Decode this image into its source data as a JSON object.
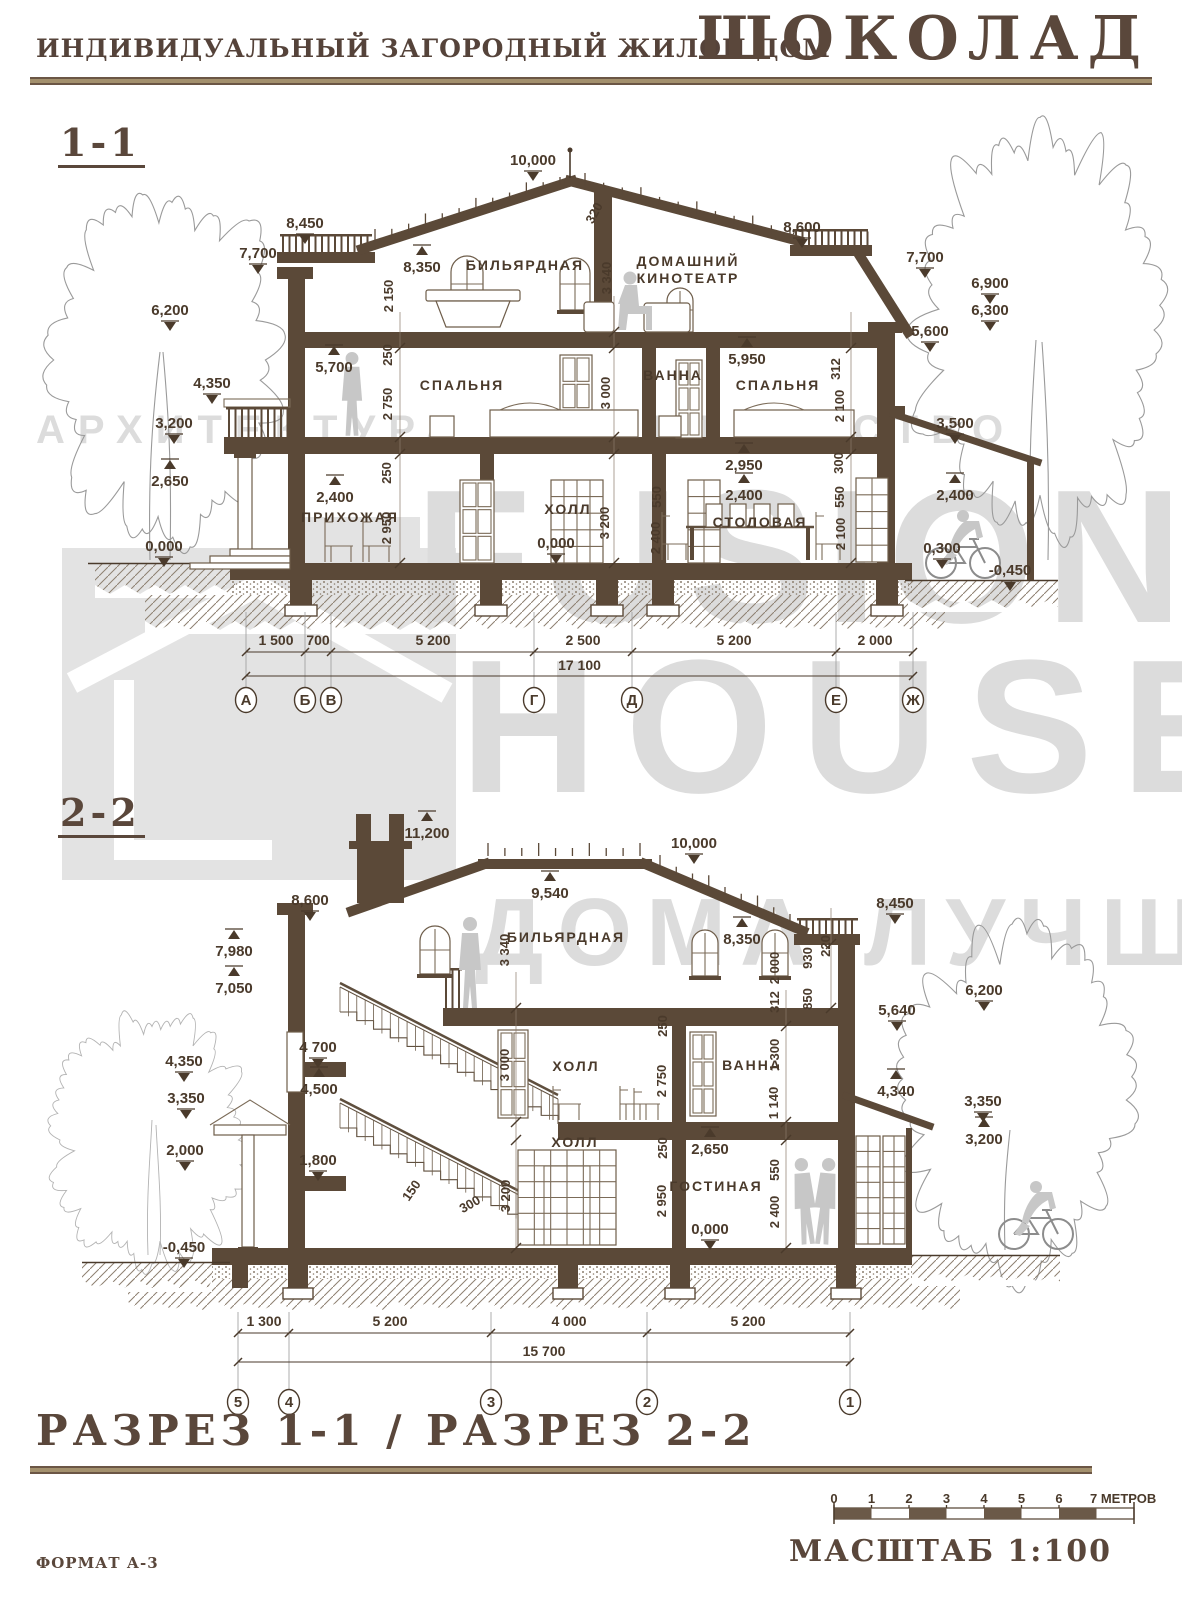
{
  "header": {
    "title": "ИНДИВИДУАЛЬНЫЙ ЗАГОРОДНЫЙ ЖИЛОЙ ДОМ",
    "logo": "ШОКОЛАД"
  },
  "watermark": {
    "tagline": "АРХИТЕКТУРА СТРОИТЕЛЬСТВО",
    "brand1": "FUSION",
    "brand2": "HOUSE",
    "slogan": "ДОМА ЛУЧШЕ!"
  },
  "colors": {
    "ink": "#4a3a2b",
    "wall": "#5b4938",
    "tan": "#a3906d",
    "watermark": "#dcdcdc"
  },
  "section1": {
    "label": "1-1",
    "rooms": [
      {
        "t": "БИЛЬЯРДНАЯ",
        "x": 525,
        "y": 270
      },
      {
        "t": "ДОМАШНИЙ",
        "x": 688,
        "y": 266
      },
      {
        "t": "КИНОТЕАТР",
        "x": 688,
        "y": 283
      },
      {
        "t": "СПАЛЬНЯ",
        "x": 462,
        "y": 390
      },
      {
        "t": "ВАННА",
        "x": 673,
        "y": 380
      },
      {
        "t": "СПАЛЬНЯ",
        "x": 778,
        "y": 390
      },
      {
        "t": "ПРИХОЖАЯ",
        "x": 350,
        "y": 522
      },
      {
        "t": "ХОЛЛ",
        "x": 568,
        "y": 514
      },
      {
        "t": "СТОЛОВАЯ",
        "x": 760,
        "y": 527
      }
    ],
    "marks": [
      {
        "v": "10,000",
        "x": 533,
        "y": 165,
        "d": "d"
      },
      {
        "v": "8,450",
        "x": 305,
        "y": 228,
        "d": "d"
      },
      {
        "v": "7,700",
        "x": 258,
        "y": 258,
        "d": "d"
      },
      {
        "v": "6,200",
        "x": 170,
        "y": 315,
        "d": "d"
      },
      {
        "v": "4,350",
        "x": 212,
        "y": 388,
        "d": "d"
      },
      {
        "v": "3,200",
        "x": 174,
        "y": 428,
        "d": "d"
      },
      {
        "v": "2,650",
        "x": 170,
        "y": 486,
        "d": "u"
      },
      {
        "v": "0,000",
        "x": 164,
        "y": 551,
        "d": "d"
      },
      {
        "v": "5,700",
        "x": 334,
        "y": 372,
        "d": "u"
      },
      {
        "v": "8,350",
        "x": 422,
        "y": 272,
        "d": "u"
      },
      {
        "v": "8,600",
        "x": 802,
        "y": 232,
        "d": "d"
      },
      {
        "v": "7,700",
        "x": 925,
        "y": 262,
        "d": "d"
      },
      {
        "v": "6,900",
        "x": 990,
        "y": 288,
        "d": "d"
      },
      {
        "v": "6,300",
        "x": 990,
        "y": 315,
        "d": "d"
      },
      {
        "v": "5,600",
        "x": 930,
        "y": 336,
        "d": "d"
      },
      {
        "v": "5,950",
        "x": 747,
        "y": 364,
        "d": "u"
      },
      {
        "v": "3,500",
        "x": 955,
        "y": 428,
        "d": "d"
      },
      {
        "v": "2,950",
        "x": 744,
        "y": 470,
        "d": "u"
      },
      {
        "v": "2,400",
        "x": 744,
        "y": 500,
        "d": "u"
      },
      {
        "v": "2,400",
        "x": 335,
        "y": 502,
        "d": "u"
      },
      {
        "v": "2,400",
        "x": 955,
        "y": 500,
        "d": "u"
      },
      {
        "v": "0,000",
        "x": 556,
        "y": 548,
        "d": "d"
      },
      {
        "v": "0,300",
        "x": 942,
        "y": 553,
        "d": "d"
      },
      {
        "v": "-0,450",
        "x": 1010,
        "y": 575,
        "d": "d"
      }
    ],
    "vdims": [
      {
        "v": "320",
        "x": 598,
        "y": 215,
        "r": -62
      },
      {
        "v": "2 150",
        "x": 393,
        "y": 296
      },
      {
        "v": "250",
        "x": 392,
        "y": 355
      },
      {
        "v": "2 750",
        "x": 392,
        "y": 404
      },
      {
        "v": "250",
        "x": 391,
        "y": 473
      },
      {
        "v": "2 950",
        "x": 391,
        "y": 528
      },
      {
        "v": "3 340",
        "x": 611,
        "y": 278
      },
      {
        "v": "3 000",
        "x": 610,
        "y": 393
      },
      {
        "v": "3 200",
        "x": 609,
        "y": 523
      },
      {
        "v": "550",
        "x": 661,
        "y": 497
      },
      {
        "v": "2 400",
        "x": 660,
        "y": 538
      },
      {
        "v": "312",
        "x": 840,
        "y": 369
      },
      {
        "v": "2 100",
        "x": 844,
        "y": 406
      },
      {
        "v": "300",
        "x": 843,
        "y": 463
      },
      {
        "v": "550",
        "x": 844,
        "y": 497
      },
      {
        "v": "2 100",
        "x": 845,
        "y": 534
      }
    ],
    "dims": [
      {
        "v": "1 500",
        "x": 276
      },
      {
        "v": "700",
        "x": 318
      },
      {
        "v": "5 200",
        "x": 433
      },
      {
        "v": "2 500",
        "x": 583
      },
      {
        "v": "5 200",
        "x": 734
      },
      {
        "v": "2 000",
        "x": 875
      }
    ],
    "total": "17 100",
    "axes": [
      {
        "v": "А",
        "x": 246
      },
      {
        "v": "Б",
        "x": 305
      },
      {
        "v": "В",
        "x": 331
      },
      {
        "v": "Г",
        "x": 534
      },
      {
        "v": "Д",
        "x": 632
      },
      {
        "v": "Е",
        "x": 836
      },
      {
        "v": "Ж",
        "x": 913
      }
    ]
  },
  "section2": {
    "label": "2-2",
    "rooms": [
      {
        "t": "БИЛЬЯРДНАЯ",
        "x": 566,
        "y": 942
      },
      {
        "t": "ХОЛЛ",
        "x": 576,
        "y": 1071
      },
      {
        "t": "ВАННА",
        "x": 752,
        "y": 1070
      },
      {
        "t": "ХОЛЛ",
        "x": 575,
        "y": 1147
      },
      {
        "t": "ГОСТИНАЯ",
        "x": 716,
        "y": 1191
      }
    ],
    "marks": [
      {
        "v": "11,200",
        "x": 427,
        "y": 838,
        "d": "u"
      },
      {
        "v": "10,000",
        "x": 694,
        "y": 848,
        "d": "d"
      },
      {
        "v": "9,540",
        "x": 550,
        "y": 898,
        "d": "u"
      },
      {
        "v": "8,600",
        "x": 310,
        "y": 905,
        "d": "d"
      },
      {
        "v": "8,450",
        "x": 895,
        "y": 908,
        "d": "d"
      },
      {
        "v": "8,350",
        "x": 742,
        "y": 944,
        "d": "u"
      },
      {
        "v": "7,980",
        "x": 234,
        "y": 956,
        "d": "u"
      },
      {
        "v": "7,050",
        "x": 234,
        "y": 993,
        "d": "u"
      },
      {
        "v": "6,200",
        "x": 984,
        "y": 995,
        "d": "d"
      },
      {
        "v": "5,640",
        "x": 897,
        "y": 1015,
        "d": "d"
      },
      {
        "v": "4 700",
        "x": 318,
        "y": 1052,
        "d": "d"
      },
      {
        "v": "4,500",
        "x": 319,
        "y": 1094,
        "d": "u"
      },
      {
        "v": "1,800",
        "x": 318,
        "y": 1165,
        "d": "d"
      },
      {
        "v": "4,350",
        "x": 184,
        "y": 1066,
        "d": "d"
      },
      {
        "v": "3,350",
        "x": 186,
        "y": 1103,
        "d": "d"
      },
      {
        "v": "2,000",
        "x": 185,
        "y": 1155,
        "d": "d"
      },
      {
        "v": "-0,450",
        "x": 184,
        "y": 1252,
        "d": "d"
      },
      {
        "v": "4,340",
        "x": 896,
        "y": 1096,
        "d": "u"
      },
      {
        "v": "3,350",
        "x": 983,
        "y": 1106,
        "d": "d"
      },
      {
        "v": "3,200",
        "x": 984,
        "y": 1144,
        "d": "u"
      },
      {
        "v": "2,650",
        "x": 710,
        "y": 1154,
        "d": "u"
      },
      {
        "v": "0,000",
        "x": 710,
        "y": 1234,
        "d": "d"
      }
    ],
    "vdims": [
      {
        "v": "3 340",
        "x": 509,
        "y": 950
      },
      {
        "v": "2 000",
        "x": 779,
        "y": 968
      },
      {
        "v": "930",
        "x": 812,
        "y": 958
      },
      {
        "v": "220",
        "x": 830,
        "y": 946
      },
      {
        "v": "850",
        "x": 812,
        "y": 999
      },
      {
        "v": "312",
        "x": 779,
        "y": 1002
      },
      {
        "v": "3 000",
        "x": 509,
        "y": 1065
      },
      {
        "v": "250",
        "x": 667,
        "y": 1026
      },
      {
        "v": "2 750",
        "x": 666,
        "y": 1081
      },
      {
        "v": "1 300",
        "x": 779,
        "y": 1055
      },
      {
        "v": "1 140",
        "x": 778,
        "y": 1103
      },
      {
        "v": "3 200",
        "x": 510,
        "y": 1196
      },
      {
        "v": "250",
        "x": 667,
        "y": 1148
      },
      {
        "v": "2 950",
        "x": 666,
        "y": 1201
      },
      {
        "v": "550",
        "x": 779,
        "y": 1170
      },
      {
        "v": "2 400",
        "x": 779,
        "y": 1212
      },
      {
        "v": "150",
        "x": 415,
        "y": 1193,
        "r": -55
      },
      {
        "v": "300",
        "x": 472,
        "y": 1208,
        "r": -30
      }
    ],
    "dims": [
      {
        "v": "1 300",
        "x": 264
      },
      {
        "v": "5 200",
        "x": 390
      },
      {
        "v": "4 000",
        "x": 569
      },
      {
        "v": "5 200",
        "x": 748
      }
    ],
    "total": "15 700",
    "axes": [
      {
        "v": "5",
        "x": 238
      },
      {
        "v": "4",
        "x": 289
      },
      {
        "v": "3",
        "x": 491
      },
      {
        "v": "2",
        "x": 647
      },
      {
        "v": "1",
        "x": 850
      }
    ]
  },
  "footer": {
    "title": "РАЗРЕЗ 1-1 / РАЗРЕЗ 2-2",
    "scale_ticks": [
      "0",
      "1",
      "2",
      "3",
      "4",
      "5",
      "6"
    ],
    "scale_last": "7 МЕТРОВ",
    "scale_label": "МАСШТАБ 1:100",
    "format": "ФОРМАТ А-3"
  }
}
